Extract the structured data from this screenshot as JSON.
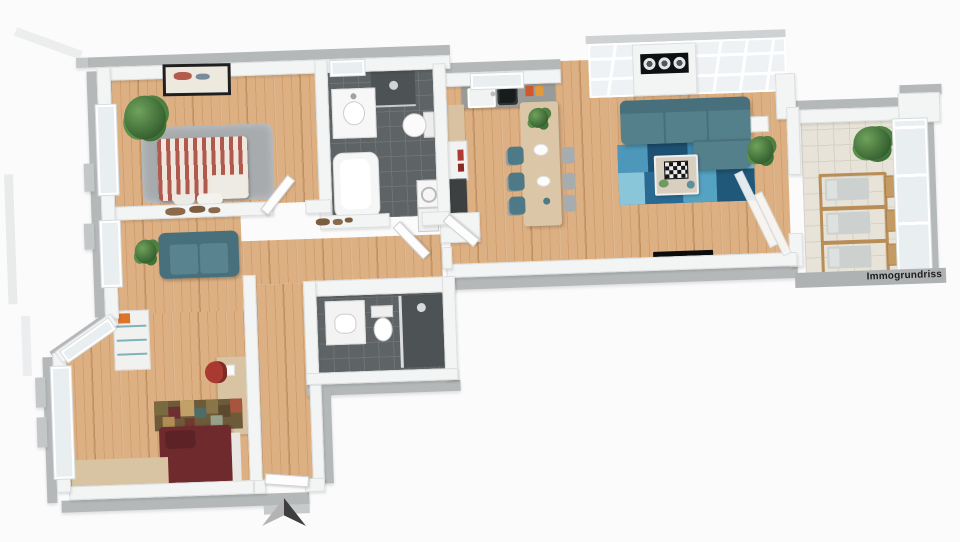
{
  "watermark": {
    "label": "Immogrundriss"
  },
  "compass": {
    "icon": "north-arrow-icon",
    "points": "up"
  },
  "colors": {
    "bg": "#fbfbfc",
    "band": "#b4b8b9",
    "band-light": "#ced2d3",
    "wall": "#f3f4f4",
    "wall-edge": "#dcdedf",
    "wood": "#ddb083",
    "wood-dark": "#cf9f70",
    "tile": "#5e6465",
    "tile-line": "#6d7374",
    "tile-shower": "#4d5354",
    "balcony-tile": "#e7e3d8",
    "balcony-line": "#d6d2c5",
    "glazing": "#e9eef0",
    "rug-gray": "#a7abad",
    "sofa-teal": "#54808c",
    "sofa-teal-dark": "#47707c",
    "chair-teal": "#4d7a86",
    "rug-base": "#2e6f96",
    "stripe-red": "#b05a4e",
    "stripe-cream": "#efe7dd",
    "bed2": "#6e2a2d",
    "bed2-dark": "#5c2225",
    "counter": "#989b97",
    "island-wood": "#dbc7a7",
    "furniture-wood": "#d8c4a3",
    "frame-wood": "#b88d57",
    "cushion": "#ccd1d0",
    "red-chair": "#a83a31",
    "orange-accent": "#dd7429",
    "art-dark": "#0e1112",
    "tv-black": "#0b0d0d",
    "compass-light": "#b3b3b3",
    "compass-dark": "#3e3e3e",
    "watermark-band": "#aeb2b3",
    "text": "#1c1c1c"
  }
}
